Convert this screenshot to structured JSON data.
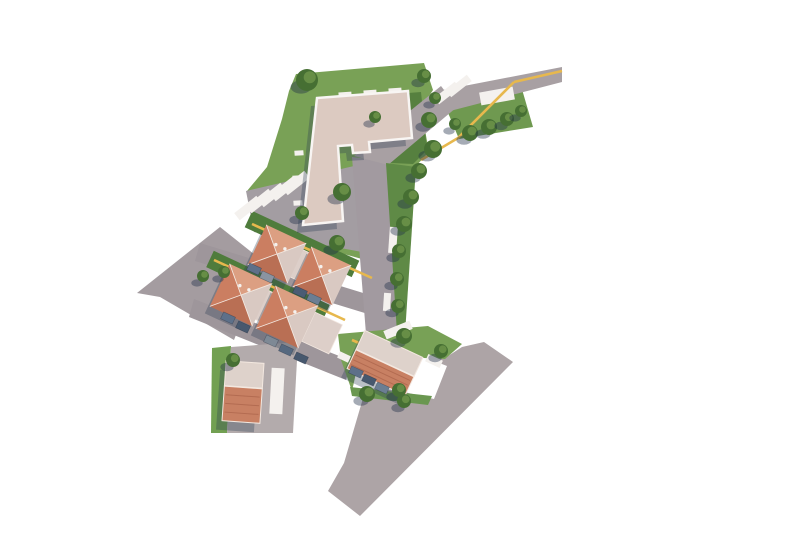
{
  "meta": {
    "type": "architectural-site-plan-rendering",
    "view": "aerial-top-down",
    "canvas": {
      "w": 800,
      "h": 533
    },
    "background": "#ffffff"
  },
  "style": {
    "grass": "#79a156",
    "grass_dark": "#56803f",
    "garden": "#4f7c3c",
    "road": "#a29aa0",
    "road_light": "#ada4a6",
    "road_lot": "#b3abac",
    "pavement": "#f4f1ee",
    "path_yellow": "#e7b84d",
    "main_roof": "#dccac1",
    "parapet": "#f8f5f3",
    "hip_top": "#dc9f82",
    "hip_left": "#cb7e61",
    "hip_bottom": "#b96f54",
    "hip_right": "#d9c9c2",
    "gable_light": "#ded2cb",
    "gable_salmon": "#c88063",
    "ridge": "#f3e8e0",
    "connector": "#ddcfc9",
    "tree_fill": "#466f33",
    "tree_hi": "rgba(125,164,84,0.6)",
    "shadow": "rgba(40,58,80,0.32)",
    "tree_shadow": "rgba(30,45,70,0.40)",
    "stripe": "rgba(140,70,50,0.35)"
  },
  "scene": {
    "greens": [
      {
        "name": "grass-main-parcel",
        "fill": "#79a156",
        "points": "296,74 424,63 433,90 421,108 429,152 415,167 404,270 394,268 344,254 299,239 261,214 247,191 267,167 282,119 289,91"
      },
      {
        "name": "grass-northeast-triangle",
        "fill": "#6f9950",
        "points": "441,96 519,79 533,127 459,139"
      },
      {
        "name": "grass-shaded-courtyard",
        "fill": "#56803f",
        "points": "370,96 421,92 427,150 413,164 372,162"
      },
      {
        "name": "grass-small-house-strip",
        "fill": "#72a052",
        "points": "212,348 231,346 227,433 211,433"
      },
      {
        "name": "grass-west-patch",
        "fill": "#6f9950",
        "points": "193,267 212,261 216,293 198,298"
      }
    ],
    "roads": [
      {
        "name": "road-west-lot",
        "fill": "#a49ca0",
        "points": "137,293 220,227 264,262 234,340 160,297"
      },
      {
        "name": "road-parking-court",
        "fill": "#a39da2",
        "points": "246,191 354,166 362,252 254,232"
      },
      {
        "name": "road-street-upper",
        "fill": "#9e969b",
        "points": "200,243 373,296 368,314 195,261"
      },
      {
        "name": "road-street-lower",
        "fill": "#9e969b",
        "points": "194,299 352,361 346,380 189,317"
      },
      {
        "name": "road-north-south-street",
        "fill": "#a29aa0",
        "points": "352,157 386,161 399,333 366,334"
      },
      {
        "name": "road-entry-diagonal",
        "fill": "#a8a0a3",
        "points": "441,86 457,107 388,165 354,156"
      },
      {
        "name": "road-top-band",
        "fill": "#a8a0a3",
        "points": "438,91 562,67 562,82 450,111"
      },
      {
        "name": "road-bottom-checkmark",
        "fill": "#ada4a6",
        "points": "366,334 399,333 445,358 462,347 484,342 513,362 360,516 328,491 344,463 366,388 400,391 434,399 447,366"
      },
      {
        "name": "road-small-house-lot",
        "fill": "#b3abac",
        "points": "231,347 298,342 293,433 227,433"
      }
    ],
    "greens_over": [
      {
        "name": "grass-bottom-parcel",
        "fill": "#78a156",
        "points": "338,334 428,326 462,344 445,359 360,355 352,391 341,360"
      },
      {
        "name": "grass-bottom-road-strip",
        "fill": "#6a9750",
        "points": "350,387 432,396 428,405 352,396"
      },
      {
        "name": "grass-street-tree-strip",
        "fill": "#5f8a46",
        "points": "386,163 416,167 405,334 397,333"
      },
      {
        "name": "garden-terrace-top",
        "fill": "#4f7c3c",
        "rect": {
          "cx": 302,
          "cy": 244,
          "w": 118,
          "h": 18,
          "rot": 25
        }
      },
      {
        "name": "garden-terrace-middle",
        "fill": "#4f7c3c",
        "rect": {
          "cx": 268,
          "cy": 286,
          "w": 128,
          "h": 18,
          "rot": 25
        }
      }
    ],
    "pavements": [
      {
        "name": "parking-stall",
        "cx": 248,
        "cy": 208,
        "w": 28,
        "h": 9,
        "rot": -38
      },
      {
        "name": "parking-stall",
        "cx": 260,
        "cy": 201,
        "w": 28,
        "h": 9,
        "rot": -38
      },
      {
        "name": "parking-stall",
        "cx": 272,
        "cy": 195,
        "w": 28,
        "h": 9,
        "rot": -38
      },
      {
        "name": "parking-stall",
        "cx": 284,
        "cy": 189,
        "w": 28,
        "h": 9,
        "rot": -38
      },
      {
        "name": "parking-stall",
        "cx": 296,
        "cy": 183,
        "w": 28,
        "h": 9,
        "rot": -38
      },
      {
        "name": "parking-stall",
        "cx": 447,
        "cy": 93,
        "w": 26,
        "h": 8,
        "rot": -38
      },
      {
        "name": "parking-stall",
        "cx": 459,
        "cy": 86,
        "w": 26,
        "h": 8,
        "rot": -38
      },
      {
        "name": "pavement-pad",
        "cx": 497,
        "cy": 96,
        "w": 34,
        "h": 13,
        "rot": -10
      },
      {
        "name": "sidewalk-strip",
        "cx": 393,
        "cy": 240,
        "w": 8,
        "h": 26,
        "rot": 4
      },
      {
        "name": "sidewalk-strip",
        "cx": 387,
        "cy": 302,
        "w": 7,
        "h": 18,
        "rot": 4
      },
      {
        "name": "sidewalk-strip",
        "cx": 398,
        "cy": 330,
        "w": 28,
        "h": 9,
        "rot": -22
      },
      {
        "name": "patio",
        "cx": 268,
        "cy": 235,
        "w": 10,
        "h": 7,
        "rot": 25
      },
      {
        "name": "patio",
        "cx": 298,
        "cy": 249,
        "w": 10,
        "h": 7,
        "rot": 25
      },
      {
        "name": "patio",
        "cx": 328,
        "cy": 263,
        "w": 10,
        "h": 7,
        "rot": 25
      },
      {
        "name": "patio",
        "cx": 232,
        "cy": 276,
        "w": 10,
        "h": 7,
        "rot": 25
      },
      {
        "name": "patio",
        "cx": 262,
        "cy": 290,
        "w": 10,
        "h": 7,
        "rot": 25
      },
      {
        "name": "patio",
        "cx": 292,
        "cy": 304,
        "w": 10,
        "h": 7,
        "rot": 25
      },
      {
        "name": "balcony",
        "cx": 299,
        "cy": 153,
        "w": 9,
        "h": 5,
        "rot": -4
      },
      {
        "name": "balcony",
        "cx": 297,
        "cy": 178,
        "w": 9,
        "h": 5,
        "rot": -4
      },
      {
        "name": "balcony",
        "cx": 298,
        "cy": 203,
        "w": 9,
        "h": 5,
        "rot": -4
      },
      {
        "name": "roof-access",
        "cx": 345,
        "cy": 94,
        "w": 13,
        "h": 4,
        "rot": -4
      },
      {
        "name": "roof-access",
        "cx": 370,
        "cy": 92,
        "w": 13,
        "h": 4,
        "rot": -4
      },
      {
        "name": "roof-access",
        "cx": 395,
        "cy": 90,
        "w": 13,
        "h": 4,
        "rot": -4
      },
      {
        "name": "driveway-strip",
        "cx": 277,
        "cy": 391,
        "w": 13,
        "h": 46,
        "rot": 3
      },
      {
        "name": "path-pad",
        "cx": 344,
        "cy": 357,
        "w": 12,
        "h": 7,
        "rot": 25
      },
      {
        "name": "path-pad",
        "cx": 434,
        "cy": 361,
        "w": 16,
        "h": 8,
        "rot": 25
      }
    ],
    "paths_yellow": [
      {
        "name": "footpath-entry",
        "points": "514,82 458,138 421,160"
      },
      {
        "name": "footpath-top-band",
        "points": "514,82 562,71"
      },
      {
        "name": "curb-terrace-top",
        "points": "252,224 372,278"
      },
      {
        "name": "curb-terrace-middle",
        "points": "214,260 345,320"
      },
      {
        "name": "curb-bottom-house",
        "points": "352,340 415,367"
      }
    ],
    "main_building": {
      "name": "apartment-building-roof",
      "path": "M317,98 L408,91 L412,138 L369,142 L370,152 L353,153 L352,145 L338,146 L343,221 L303,225 Z",
      "fill": "#dccac1",
      "stroke": "#f8f5f3",
      "stroke_width": 2.5
    },
    "terraces": [
      {
        "name": "terrace-row-top",
        "units": [
          {
            "cx": 277,
            "cy": 254,
            "size": 44,
            "rot": 25
          },
          {
            "cx": 322,
            "cy": 276,
            "size": 44,
            "rot": 25
          }
        ],
        "connectors": [
          {
            "cx": 300,
            "cy": 265,
            "w": 26,
            "h": 30,
            "rot": 25
          }
        ]
      },
      {
        "name": "terrace-row-middle",
        "units": [
          {
            "cx": 241,
            "cy": 295,
            "size": 47,
            "rot": 25
          },
          {
            "cx": 287,
            "cy": 317,
            "size": 47,
            "rot": 25
          }
        ],
        "connectors": [
          {
            "cx": 264,
            "cy": 306,
            "w": 26,
            "h": 32,
            "rot": 25
          },
          {
            "cx": 322,
            "cy": 333,
            "w": 30,
            "h": 32,
            "rot": 25
          }
        ]
      }
    ],
    "gable_houses": [
      {
        "name": "detached-house-south",
        "cx": 385,
        "cy": 363,
        "len": 64,
        "dep": 42,
        "rot": 25,
        "ridge_frac": 0.5
      },
      {
        "name": "detached-house-west",
        "cx": 243,
        "cy": 392,
        "len": 38,
        "dep": 60,
        "rot": 4,
        "ridge_frac": 0.42
      }
    ],
    "cars": [
      {
        "x": 254,
        "y": 269,
        "rot": 25,
        "color": "#5d7089"
      },
      {
        "x": 267,
        "y": 277,
        "rot": 25,
        "color": "#8a94a1"
      },
      {
        "x": 300,
        "y": 292,
        "rot": 25,
        "color": "#4a5c74"
      },
      {
        "x": 314,
        "y": 299,
        "rot": 25,
        "color": "#6b7e93"
      },
      {
        "x": 228,
        "y": 318,
        "rot": 25,
        "color": "#5d7089"
      },
      {
        "x": 243,
        "y": 327,
        "rot": 25,
        "color": "#47586e"
      },
      {
        "x": 271,
        "y": 341,
        "rot": 25,
        "color": "#7e8995"
      },
      {
        "x": 286,
        "y": 350,
        "rot": 25,
        "color": "#55687f"
      },
      {
        "x": 301,
        "y": 358,
        "rot": 25,
        "color": "#47586e"
      },
      {
        "x": 356,
        "y": 372,
        "rot": 25,
        "color": "#5d7089"
      },
      {
        "x": 369,
        "y": 380,
        "rot": 25,
        "color": "#47586e"
      },
      {
        "x": 382,
        "y": 388,
        "rot": 25,
        "color": "#6b7e93"
      }
    ],
    "trees": [
      {
        "x": 307,
        "y": 80,
        "r": 11
      },
      {
        "x": 424,
        "y": 76,
        "r": 7
      },
      {
        "x": 435,
        "y": 98,
        "r": 6
      },
      {
        "x": 429,
        "y": 120,
        "r": 8
      },
      {
        "x": 433,
        "y": 149,
        "r": 9
      },
      {
        "x": 419,
        "y": 171,
        "r": 8
      },
      {
        "x": 411,
        "y": 197,
        "r": 8
      },
      {
        "x": 404,
        "y": 224,
        "r": 8
      },
      {
        "x": 399,
        "y": 251,
        "r": 7
      },
      {
        "x": 397,
        "y": 279,
        "r": 7
      },
      {
        "x": 398,
        "y": 306,
        "r": 7
      },
      {
        "x": 455,
        "y": 124,
        "r": 6
      },
      {
        "x": 470,
        "y": 133,
        "r": 8
      },
      {
        "x": 489,
        "y": 127,
        "r": 8
      },
      {
        "x": 507,
        "y": 119,
        "r": 7
      },
      {
        "x": 521,
        "y": 111,
        "r": 6
      },
      {
        "x": 375,
        "y": 117,
        "r": 6
      },
      {
        "x": 342,
        "y": 192,
        "r": 9
      },
      {
        "x": 302,
        "y": 213,
        "r": 7
      },
      {
        "x": 337,
        "y": 243,
        "r": 8
      },
      {
        "x": 224,
        "y": 272,
        "r": 6
      },
      {
        "x": 404,
        "y": 336,
        "r": 8
      },
      {
        "x": 441,
        "y": 351,
        "r": 7
      },
      {
        "x": 367,
        "y": 394,
        "r": 8
      },
      {
        "x": 399,
        "y": 390,
        "r": 7
      },
      {
        "x": 404,
        "y": 401,
        "r": 7
      },
      {
        "x": 233,
        "y": 360,
        "r": 7
      },
      {
        "x": 203,
        "y": 276,
        "r": 6
      }
    ]
  }
}
